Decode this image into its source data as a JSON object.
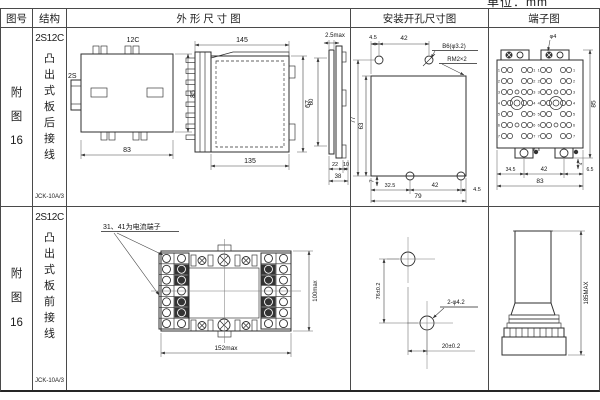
{
  "page": {
    "unit_label": "单位：mm",
    "colors": {
      "ink": "#2b2b2b",
      "background": "#ffffff"
    }
  },
  "header": {
    "figure_no": "图号",
    "structure": "结构",
    "outline": "外 形 尺 寸 图",
    "mounting": "安装开孔尺寸图",
    "terminal": "端子图"
  },
  "rows": [
    {
      "figure_no": "附图16",
      "structure": {
        "code": "2S12C",
        "type": "凸出式板后接线",
        "model": "JCK-10A/3"
      },
      "outline": {
        "rear": {
          "top_label": "12C",
          "side_label": "2S",
          "height": "85",
          "width": "83"
        },
        "side": {
          "width_top": "145",
          "width_bottom": "135",
          "height": "67"
        },
        "edge": {
          "thickness": "2.5max",
          "height": "60",
          "d1": "22",
          "d2": "10",
          "total": "38"
        }
      },
      "mounting": {
        "top_d1": "4.5",
        "top_d2": "42",
        "hole_label": "B6(φ3.2)",
        "thread_label": "RM2×2",
        "height_outer": "77",
        "height_inner": "63",
        "bottom_offset": "7",
        "bottom_d1": "32.5",
        "bottom_d2": "42",
        "bottom_d3": "4.5",
        "bottom_total": "79"
      },
      "terminal": {
        "hole_label": "φ4",
        "height": "85",
        "tab_dim": "4",
        "bottom_d1": "34.5",
        "bottom_d2": "42",
        "bottom_d3": "6.5",
        "bottom_total": "83",
        "row_numbers": [
          "1",
          "2",
          "3",
          "4",
          "5",
          "6",
          "7"
        ],
        "bottom_row_number": "8"
      }
    },
    {
      "figure_no": "附图16",
      "structure": {
        "code": "2S12C",
        "type": "凸出式板前接线",
        "model": "JCK-10A/3"
      },
      "outline": {
        "note": "31、41为电流端子",
        "height": "100max",
        "width": "152max"
      },
      "mounting": {
        "vertical": "76±0.2",
        "horizontal": "20±0.2",
        "hole_label": "2-φ4.2"
      },
      "terminal": {
        "height": "185MAX"
      }
    }
  ]
}
